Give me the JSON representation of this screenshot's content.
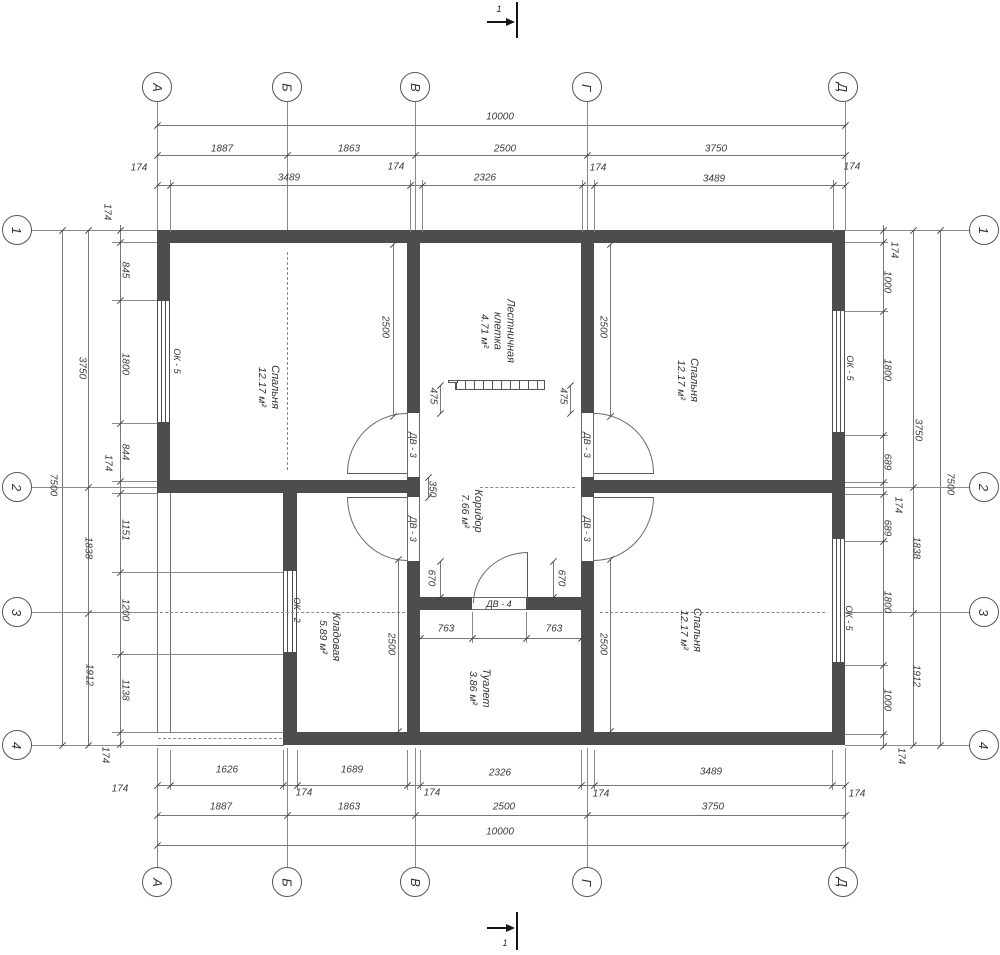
{
  "axes": {
    "top": [
      {
        "label": "А",
        "x": 157
      },
      {
        "label": "Б",
        "x": 287
      },
      {
        "label": "В",
        "x": 415
      },
      {
        "label": "Г",
        "x": 587
      },
      {
        "label": "Д",
        "x": 843
      }
    ],
    "bottom": [
      {
        "label": "А",
        "x": 157
      },
      {
        "label": "Б",
        "x": 287
      },
      {
        "label": "В",
        "x": 415
      },
      {
        "label": "Г",
        "x": 587
      },
      {
        "label": "Д",
        "x": 843
      }
    ],
    "left": [
      {
        "label": "1",
        "y": 230
      },
      {
        "label": "2",
        "y": 487
      },
      {
        "label": "3",
        "y": 612
      },
      {
        "label": "4",
        "y": 745
      }
    ],
    "right": [
      {
        "label": "1",
        "y": 230
      },
      {
        "label": "2",
        "y": 487
      },
      {
        "label": "3",
        "y": 612
      },
      {
        "label": "4",
        "y": 745
      }
    ]
  },
  "section_markers": {
    "top": "1",
    "bottom": "1"
  },
  "rooms": [
    {
      "lines": [
        "Спальня"
      ],
      "area": "12.17 м²",
      "x": 268,
      "y": 387
    },
    {
      "lines": [
        "Спальня"
      ],
      "area": "12.17 м²",
      "x": 687,
      "y": 380
    },
    {
      "lines": [
        "Спальня"
      ],
      "area": "12.17 м²",
      "x": 690,
      "y": 630
    },
    {
      "lines": [
        "Лестничная",
        "клетка"
      ],
      "area": "4.71 м²",
      "x": 497,
      "y": 331
    },
    {
      "lines": [
        "Коридор"
      ],
      "area": "7.66 м²",
      "x": 471,
      "y": 511
    },
    {
      "lines": [
        "Кладовая"
      ],
      "area": "5.89 м²",
      "x": 329,
      "y": 637
    },
    {
      "lines": [
        "Туалет"
      ],
      "area": "3.86 м²",
      "x": 479,
      "y": 688
    }
  ],
  "window_labels": [
    {
      "label": "ОК - 5",
      "x": 177,
      "y": 361
    },
    {
      "label": "ОК - 5",
      "x": 850,
      "y": 368
    },
    {
      "label": "ОК - 5",
      "x": 849,
      "y": 618
    },
    {
      "label": "ОК - 2",
      "x": 297,
      "y": 610
    }
  ],
  "door_labels": [
    {
      "label": "ДВ - 3",
      "x": 413,
      "y": 445,
      "r": 1
    },
    {
      "label": "ДВ - 3",
      "x": 413,
      "y": 529,
      "r": 1
    },
    {
      "label": "ДВ - 3",
      "x": 587,
      "y": 445,
      "r": 1
    },
    {
      "label": "ДВ - 3",
      "x": 587,
      "y": 529,
      "r": 1
    },
    {
      "label": "ДВ - 4",
      "x": 499,
      "y": 604,
      "r": 0
    }
  ],
  "dim_labels": [
    [
      "10000",
      500,
      117,
      0
    ],
    [
      "1887",
      222,
      149,
      0
    ],
    [
      "1863",
      349,
      149,
      0
    ],
    [
      "2500",
      505,
      149,
      0
    ],
    [
      "3750",
      716,
      149,
      0
    ],
    [
      "174",
      139,
      168,
      0
    ],
    [
      "3489",
      289,
      178,
      0
    ],
    [
      "174",
      396,
      167,
      0
    ],
    [
      "2326",
      485,
      178,
      0
    ],
    [
      "174",
      598,
      168,
      0
    ],
    [
      "3489",
      714,
      179,
      0
    ],
    [
      "174",
      852,
      167,
      0
    ],
    [
      "1626",
      227,
      770,
      0
    ],
    [
      "1689",
      352,
      770,
      0
    ],
    [
      "2326",
      500,
      773,
      0
    ],
    [
      "3489",
      711,
      772,
      0
    ],
    [
      "174",
      120,
      789,
      0
    ],
    [
      "174",
      304,
      793,
      0
    ],
    [
      "174",
      432,
      793,
      0
    ],
    [
      "174",
      601,
      794,
      0
    ],
    [
      "174",
      857,
      794,
      0
    ],
    [
      "1887",
      221,
      807,
      0
    ],
    [
      "1863",
      349,
      807,
      0
    ],
    [
      "2500",
      504,
      807,
      0
    ],
    [
      "3750",
      713,
      807,
      0
    ],
    [
      "10000",
      500,
      832,
      0
    ],
    [
      "174",
      105,
      755,
      1
    ],
    [
      "174",
      901,
      756,
      1
    ],
    [
      "7500",
      53,
      485,
      1
    ],
    [
      "3750",
      82,
      368,
      1
    ],
    [
      "1838",
      88,
      548,
      1
    ],
    [
      "1912",
      89,
      675,
      1
    ],
    [
      "174",
      107,
      212,
      1
    ],
    [
      "845",
      125,
      270,
      1
    ],
    [
      "1800",
      125,
      364,
      1
    ],
    [
      "844",
      125,
      452,
      1
    ],
    [
      "174",
      108,
      463,
      1
    ],
    [
      "1151",
      125,
      530,
      1
    ],
    [
      "1200",
      125,
      610,
      1
    ],
    [
      "1138",
      125,
      690,
      1
    ],
    [
      "174",
      894,
      250,
      1
    ],
    [
      "1000",
      887,
      282,
      1
    ],
    [
      "1800",
      887,
      370,
      1
    ],
    [
      "689",
      887,
      462,
      1
    ],
    [
      "174",
      898,
      505,
      1
    ],
    [
      "689",
      887,
      528,
      1
    ],
    [
      "1800",
      887,
      602,
      1
    ],
    [
      "1000",
      887,
      700,
      1
    ],
    [
      "3750",
      918,
      430,
      1
    ],
    [
      "1838",
      916,
      548,
      1
    ],
    [
      "1912",
      916,
      676,
      1
    ],
    [
      "7500",
      950,
      484,
      1
    ],
    [
      "2500",
      385,
      327,
      1
    ],
    [
      "2500",
      603,
      327,
      1
    ],
    [
      "2500",
      603,
      644,
      1
    ],
    [
      "2500",
      391,
      644,
      1
    ],
    [
      "475",
      433,
      396,
      1
    ],
    [
      "475",
      563,
      396,
      1
    ],
    [
      "350",
      432,
      489,
      1
    ],
    [
      "670",
      431,
      578,
      1
    ],
    [
      "670",
      561,
      578,
      1
    ],
    [
      "763",
      446,
      629,
      0
    ],
    [
      "763",
      554,
      629,
      0
    ]
  ]
}
